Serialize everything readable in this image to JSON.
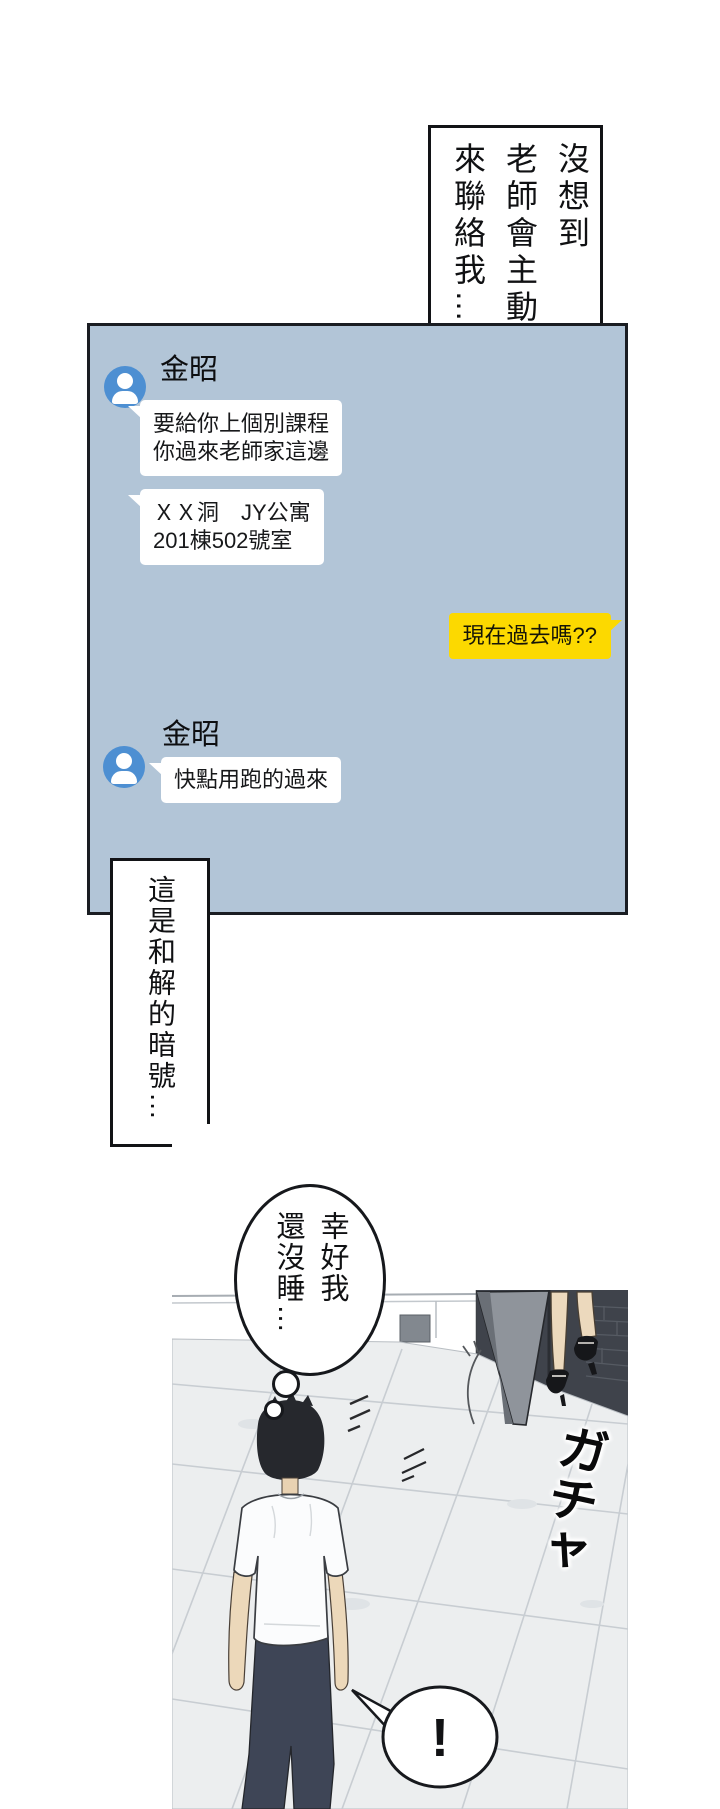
{
  "page": {
    "background": "#ffffff",
    "narration_top": {
      "lines": [
        "沒想到",
        "老師會主動",
        "來聯絡我…"
      ]
    },
    "narration_mid": {
      "lines": [
        "這是和解的暗號…"
      ]
    },
    "thought": {
      "lines": [
        "幸好我",
        "還沒睡…"
      ]
    },
    "sfx": "ガチャ",
    "exclamation": "!"
  },
  "chat": {
    "sender": "金昭",
    "messages": [
      {
        "from": "teacher",
        "lines": [
          "要給你上個別課程",
          "你過來老師家這邊"
        ]
      },
      {
        "from": "teacher",
        "lines": [
          "ＸＸ洞　JY公寓",
          "201棟502號室"
        ]
      },
      {
        "from": "me",
        "lines": [
          "現在過去嗎??"
        ]
      },
      {
        "from": "teacher",
        "lines": [
          "快點用跑的過來"
        ]
      }
    ],
    "colors": {
      "panel_bg": "#b2c5d7",
      "panel_border": "#1a1d22",
      "bubble_other": "#ffffff",
      "bubble_self": "#fcd900",
      "avatar": "#4d8fd2"
    }
  }
}
